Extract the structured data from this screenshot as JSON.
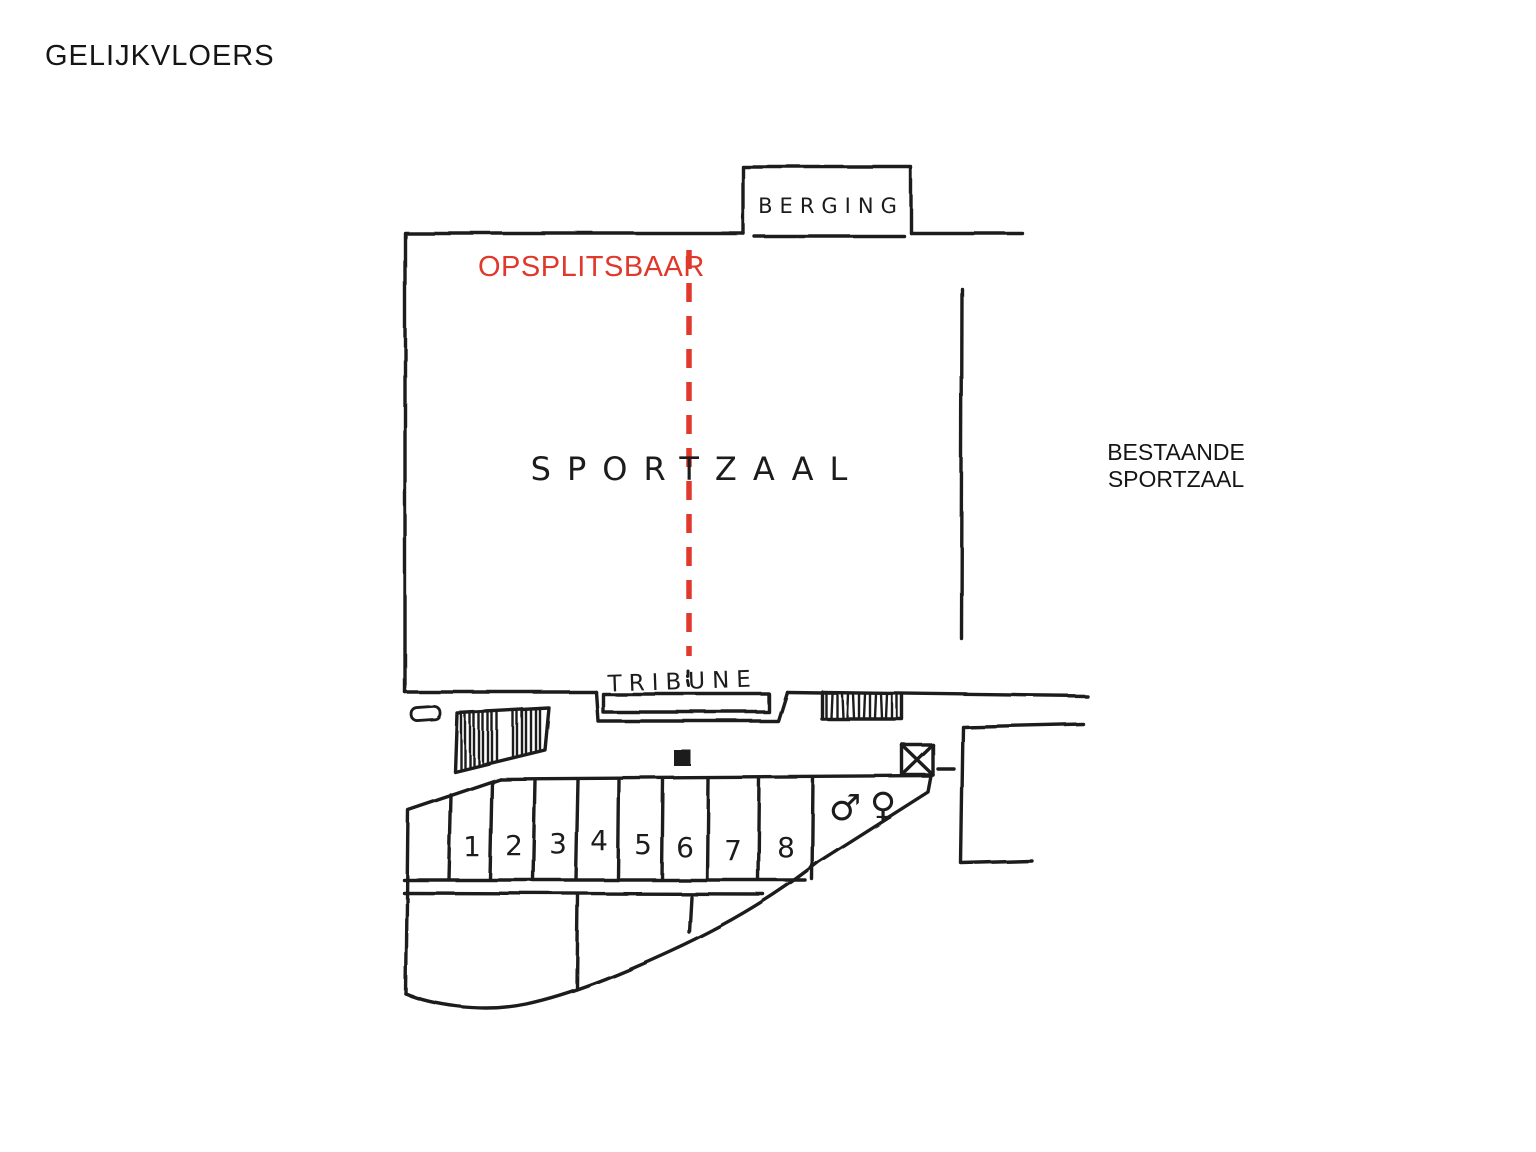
{
  "page": {
    "title": "GELIJKVLOERS",
    "background_color": "#ffffff",
    "ink_color": "#1f1f1f",
    "accent_color": "#e0392b"
  },
  "plan": {
    "floor_title": "GELIJKVLOERS",
    "divisible_label": "OPSPLITSBAAR",
    "storage_label": "BERGING",
    "hall_label": "SPORTZAAL",
    "grandstand_label": "TRIBUNE",
    "existing_hall_label_line1": "BESTAANDE",
    "existing_hall_label_line2": "SPORTZAAL",
    "changing_room_numbers": [
      "1",
      "2",
      "3",
      "4",
      "5",
      "6",
      "7",
      "8"
    ],
    "mens_symbol": "♂",
    "womens_symbol": "♀"
  }
}
